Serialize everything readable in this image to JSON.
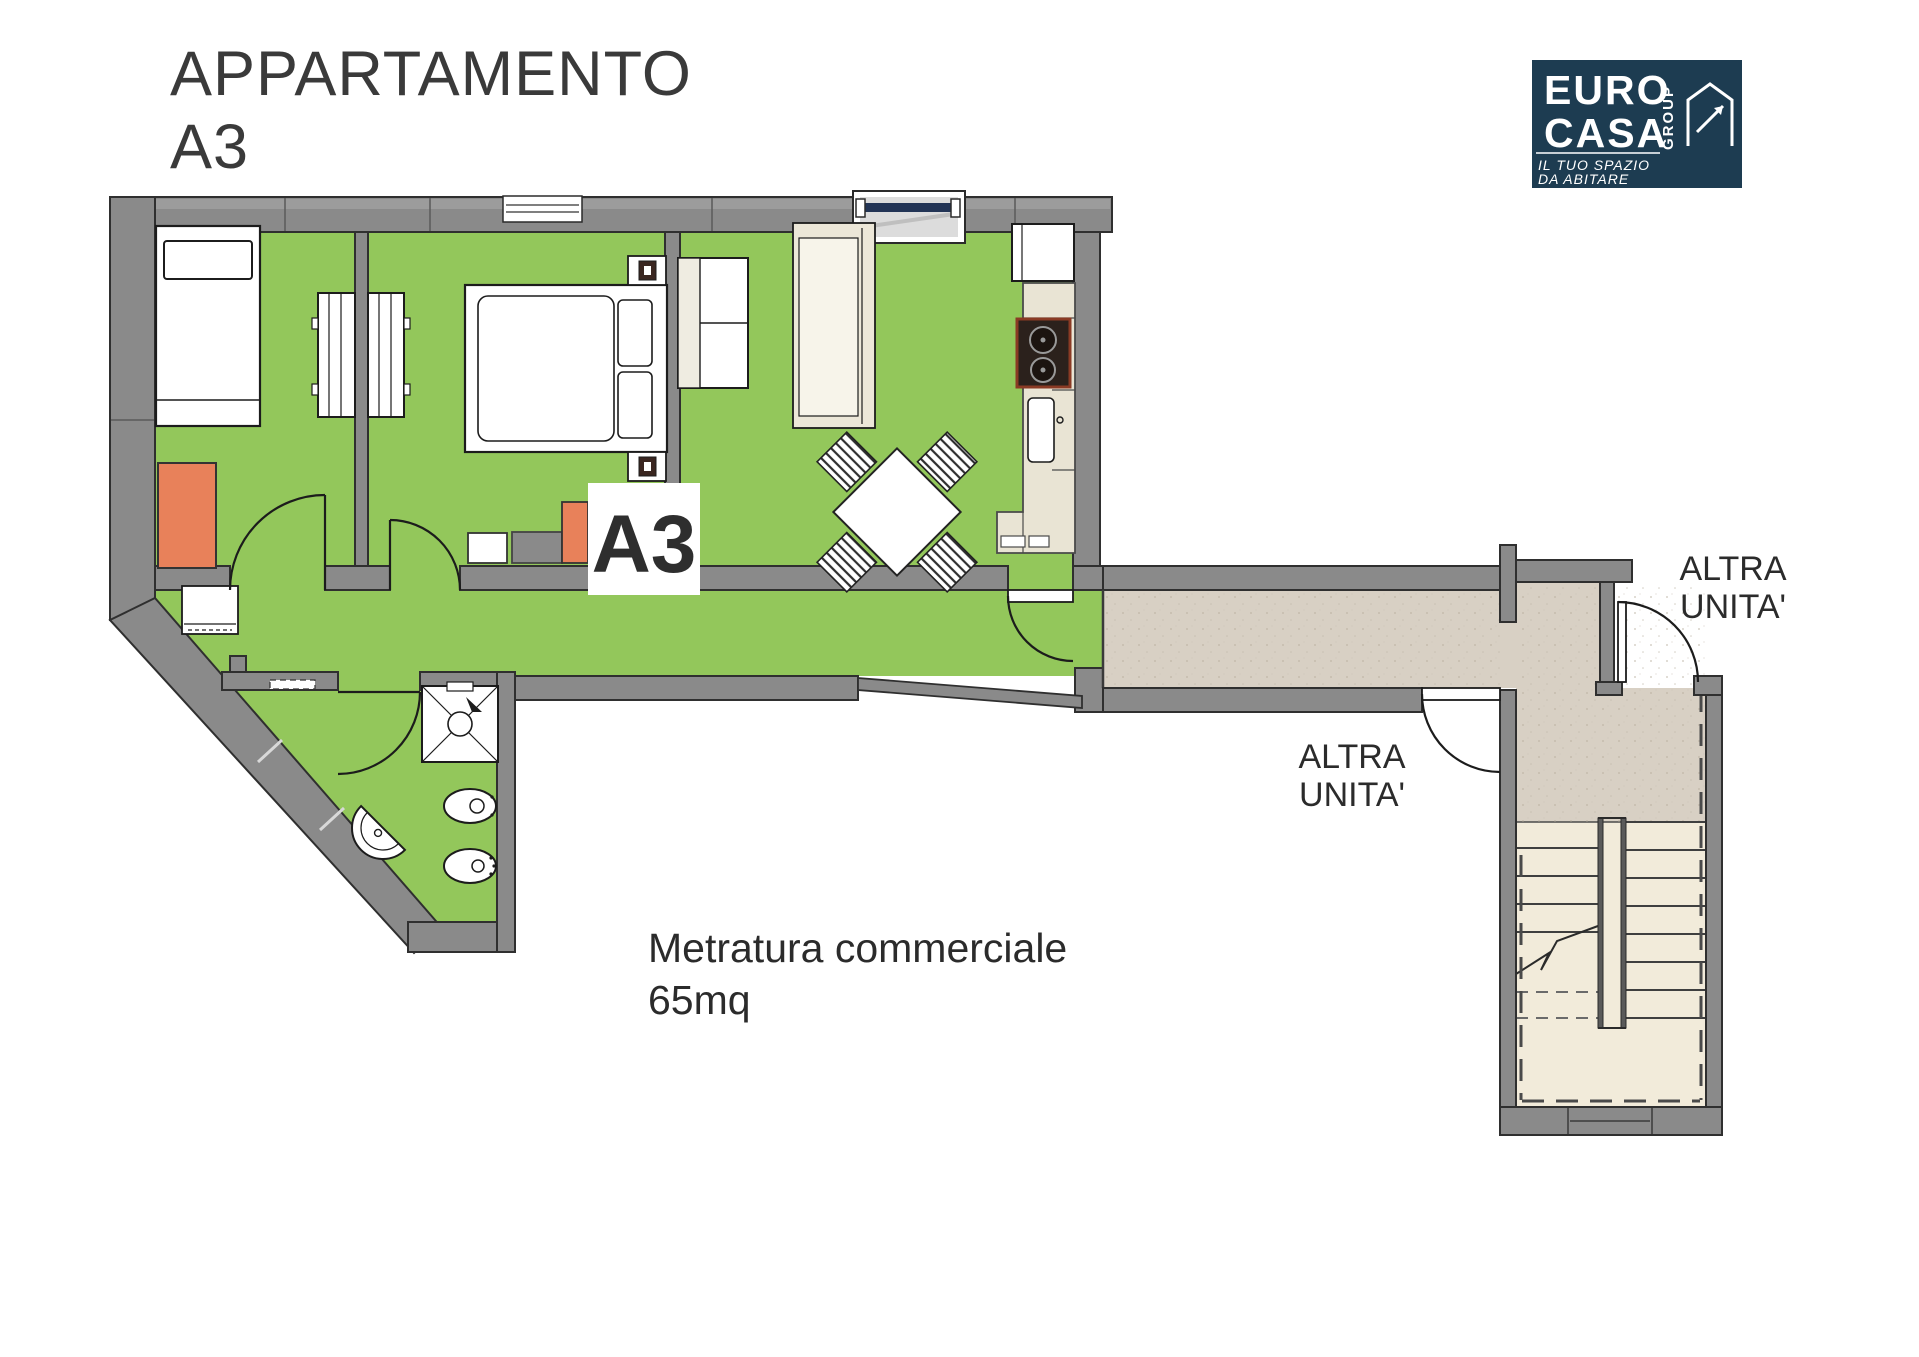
{
  "title": {
    "line1": "APPARTAMENTO",
    "line2": "A3"
  },
  "plan": {
    "unit_label": "A3",
    "area_note": {
      "line1": "Metratura commerciale",
      "line2": "65mq"
    },
    "other_unit_top": {
      "line1": "ALTRA",
      "line2": "UNITA'"
    },
    "other_unit_mid": {
      "line1": "ALTRA",
      "line2": "UNITA'"
    }
  },
  "logo": {
    "name_line1": "EURO",
    "name_line2": "CASA",
    "group_vertical": "GROUP",
    "tagline_line1": "IL TUO SPAZIO",
    "tagline_line2": "DA ABITARE"
  },
  "colors": {
    "floor_green": "#93c75b",
    "corridor_beige": "#d8d0c4",
    "stair_cream": "#f2ebda",
    "wall_gray": "#8a8a8a",
    "accent_orange": "#e8815a",
    "logo_navy": "#1d3c51",
    "window_navy": "#223455"
  }
}
